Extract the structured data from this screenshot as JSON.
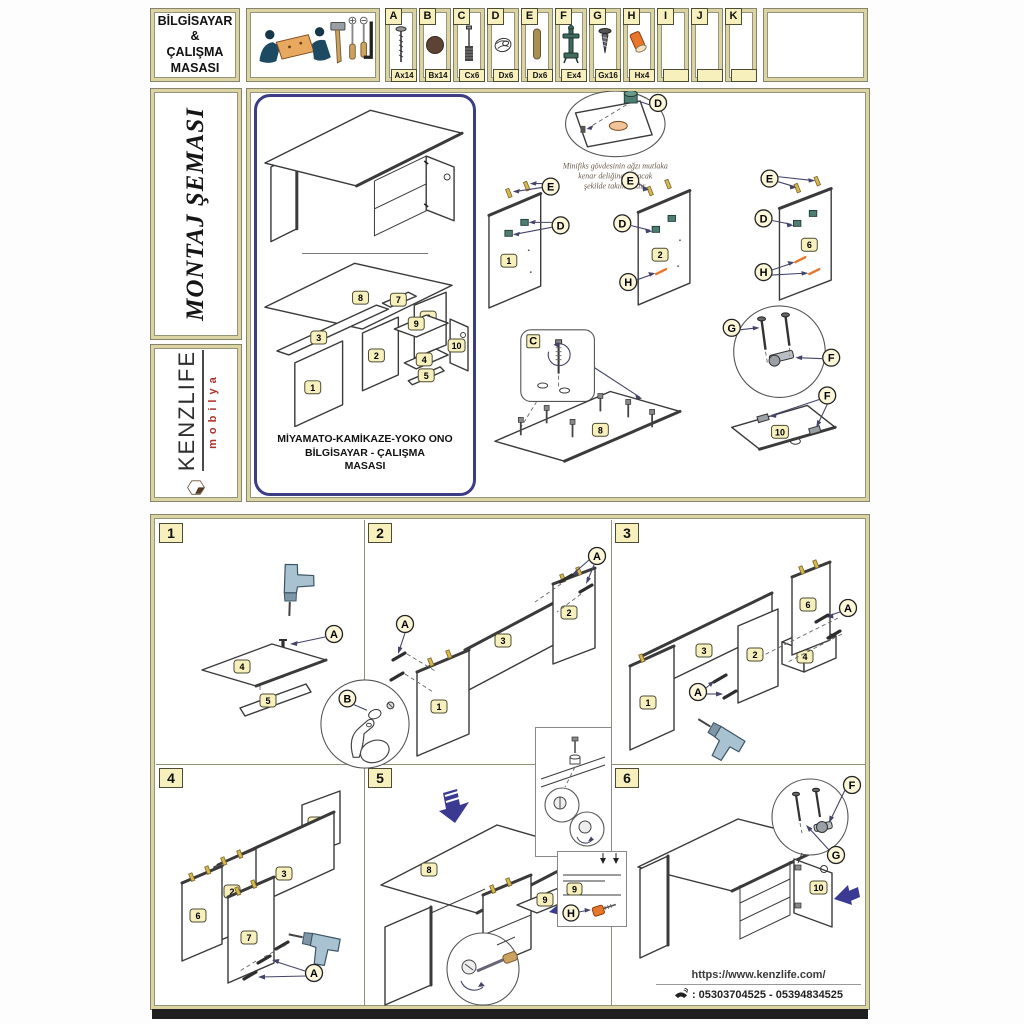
{
  "header": {
    "title_lines": [
      "BİLGİSAYAR",
      "&",
      "ÇALIŞMA",
      "MASASI"
    ],
    "parts": [
      {
        "letter": "A",
        "qty": "Ax14",
        "icon": "bolt-screw"
      },
      {
        "letter": "B",
        "qty": "Bx14",
        "icon": "cover-cap"
      },
      {
        "letter": "C",
        "qty": "Cx6",
        "icon": "cam-bolt"
      },
      {
        "letter": "D",
        "qty": "Dx6",
        "icon": "cam-lock"
      },
      {
        "letter": "E",
        "qty": "Dx6",
        "icon": "wood-dowel"
      },
      {
        "letter": "F",
        "qty": "Ex4",
        "icon": "hinge"
      },
      {
        "letter": "G",
        "qty": "Gx16",
        "icon": "chipboard-screw"
      },
      {
        "letter": "H",
        "qty": "Hx4",
        "icon": "plastic-cap"
      },
      {
        "letter": "I",
        "qty": "",
        "icon": "empty"
      },
      {
        "letter": "J",
        "qty": "",
        "icon": "empty"
      },
      {
        "letter": "K",
        "qty": "",
        "icon": "empty"
      }
    ]
  },
  "sidebar": {
    "schema_title": "MONTAJ ŞEMASI",
    "brand": "KENZLIFE",
    "brand_sub": "mobilya"
  },
  "overview": {
    "model_lines": [
      "MİYAMATO-KAMİKAZE-YOKO ONO",
      "BİLGİSAYAR - ÇALIŞMA",
      "MASASI"
    ],
    "note_lines": [
      "Minifiks gövdesinin ağzı mutlaka",
      "kenar deliğine bakacak",
      "şekilde takılmalıdır."
    ],
    "callouts": {
      "c": "C",
      "d": "D",
      "e": "E",
      "f": "F",
      "g": "G",
      "h": "H"
    },
    "panels": {
      "n1": "1",
      "n2": "2",
      "n3": "3",
      "n4": "4",
      "n5": "5",
      "n6": "6",
      "n7": "7",
      "n8": "8",
      "n9": "9",
      "n10": "10"
    }
  },
  "steps": [
    {
      "number": "1",
      "callouts": [
        "A",
        "B"
      ],
      "panels": [
        "4",
        "5"
      ]
    },
    {
      "number": "2",
      "callouts": [
        "A",
        "A"
      ],
      "panels": [
        "1",
        "3",
        "2"
      ]
    },
    {
      "number": "3",
      "callouts": [
        "A",
        "A"
      ],
      "panels": [
        "1",
        "3",
        "2",
        "4",
        "6"
      ]
    },
    {
      "number": "4",
      "callouts": [
        "A"
      ],
      "panels": [
        "1",
        "3",
        "2",
        "6",
        "7"
      ]
    },
    {
      "number": "5",
      "callouts": [],
      "panels": [
        "8",
        "9"
      ],
      "detail": {
        "panel": "9",
        "callout": "H"
      }
    },
    {
      "number": "6",
      "callouts": [
        "F",
        "G"
      ],
      "panels": [
        "10"
      ]
    }
  ],
  "footer": {
    "url": "https://www.kenzlife.com/",
    "phone": ": 05303704525 - 05394834525"
  },
  "colors": {
    "frame_tan": "#dcd3a2",
    "badge_yellow": "#f7f0bd",
    "navy_accent": "#3d3d85",
    "arrow_blue": "#3a3a92",
    "orange_part": "#e8762a",
    "teal_cam": "#4e7d72",
    "dowel_yellow": "#d9b94e",
    "brand_red": "#b03028"
  }
}
